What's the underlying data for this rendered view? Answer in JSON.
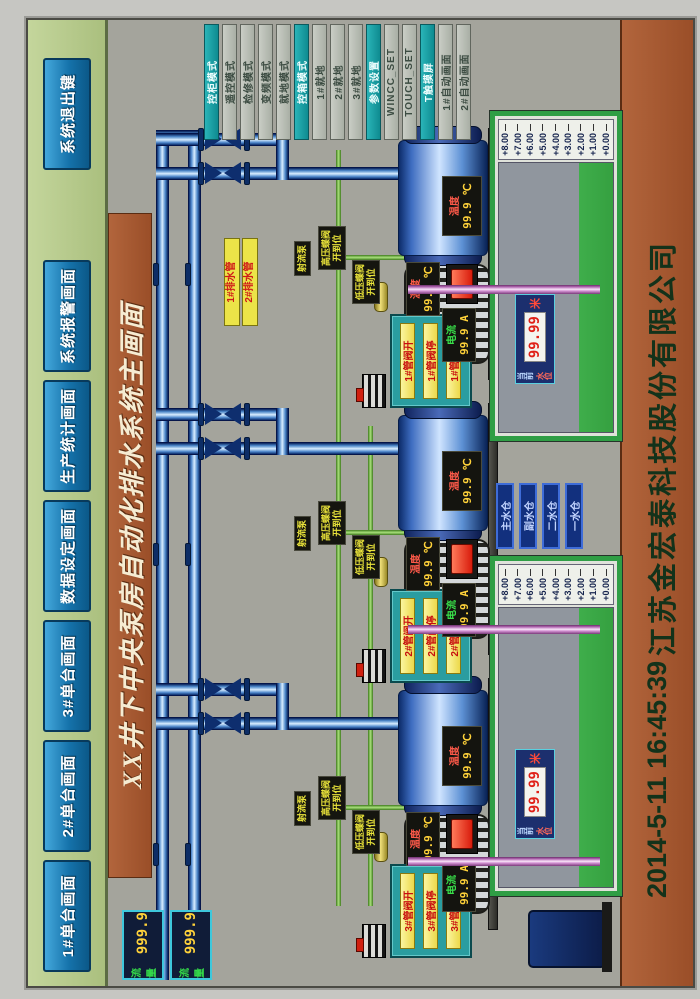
{
  "title": "XX井下中央泵房自动化排水系统主画面",
  "menu": {
    "buttons": [
      "1#单台画面",
      "2#单台画面",
      "3#单台画面",
      "数据设定画面",
      "生产统计画面",
      "系统报警画面"
    ],
    "exit": "系统退出键"
  },
  "mode_buttons": [
    "控柜模式",
    "遥控模式",
    "检修模式",
    "变频模式",
    "就地模式",
    "控箱模式",
    "1#就地",
    "2#就地",
    "3#就地",
    "参数设置",
    "WINCC_SET",
    "TOUCH_SET",
    "T触摸屏",
    "1#自动画面",
    "2#自动画面"
  ],
  "flow_meters": [
    {
      "label": "流量",
      "value": "999.9"
    },
    {
      "label": "流量",
      "value": "999.9"
    }
  ],
  "pipe_labels": [
    "1#排水管",
    "2#排水管"
  ],
  "units": [
    {
      "num": "3#",
      "valve_open": "3#管阀开",
      "valve_stop": "3#管阀停",
      "valve_close": "3#管阀关",
      "pump_temp_label": "温度",
      "pump_temp_value": "99.9 ℃",
      "motor_temp_label": "温度",
      "motor_temp_value": "99.9 ℃",
      "motor_current_label": "电流",
      "motor_current_value": "99.9 A",
      "jet_pump_label": "射流泵",
      "hv_line1": "高压蝶阀",
      "hv_line2": "开到位",
      "lv_line1": "低压蝶阀",
      "lv_line2": "开到位"
    },
    {
      "num": "2#",
      "valve_open": "2#管阀开",
      "valve_stop": "2#管阀停",
      "valve_close": "2#管阀关",
      "pump_temp_label": "温度",
      "pump_temp_value": "99.9 ℃",
      "motor_temp_label": "温度",
      "motor_temp_value": "99.9 ℃",
      "motor_current_label": "电流",
      "motor_current_value": "99.9 A",
      "jet_pump_label": "射流泵",
      "hv_line1": "高压蝶阀",
      "hv_line2": "开到位",
      "lv_line1": "低压蝶阀",
      "lv_line2": "开到位"
    },
    {
      "num": "1#",
      "valve_open": "1#管阀开",
      "valve_stop": "1#管阀停",
      "valve_close": "1#管阀关",
      "pump_temp_label": "温度",
      "pump_temp_value": "99.9 ℃",
      "motor_temp_label": "温度",
      "motor_temp_value": "99.9 ℃",
      "motor_current_label": "电流",
      "motor_current_value": "99.9 A",
      "jet_pump_label": "射流泵",
      "hv_line1": "高压蝶阀",
      "hv_line2": "开到位",
      "lv_line1": "低压蝶阀",
      "lv_line2": "开到位"
    }
  ],
  "sumps": [
    {
      "label_line1": "当前",
      "label_line2": "水位",
      "value": "99.99",
      "unit": "米"
    },
    {
      "label_line1": "当前",
      "label_line2": "水位",
      "value": "99.99",
      "unit": "米"
    }
  ],
  "levels": [
    "+8.00",
    "+7.00",
    "+6.00",
    "+5.00",
    "+4.00",
    "+3.00",
    "+2.00",
    "+1.00",
    "+0.00"
  ],
  "sump_buttons": [
    "主水仓",
    "副水仓",
    "二水仓",
    "一水仓"
  ],
  "footer": {
    "datetime": "2014-5-11  16:45:39",
    "company": "江苏金宏泰科技股份有限公司"
  },
  "colors": {
    "menu_bar": "#b5c98c",
    "button_blue": "#1572aa",
    "title_brown": "#a2552c",
    "panel_teal": "#2a9da0",
    "mode_active": "#129094",
    "screen_gray": "#a4a49c",
    "sump_green": "#2f9e45",
    "led_yellow": "#ffd23a",
    "led_red": "#e02018"
  }
}
